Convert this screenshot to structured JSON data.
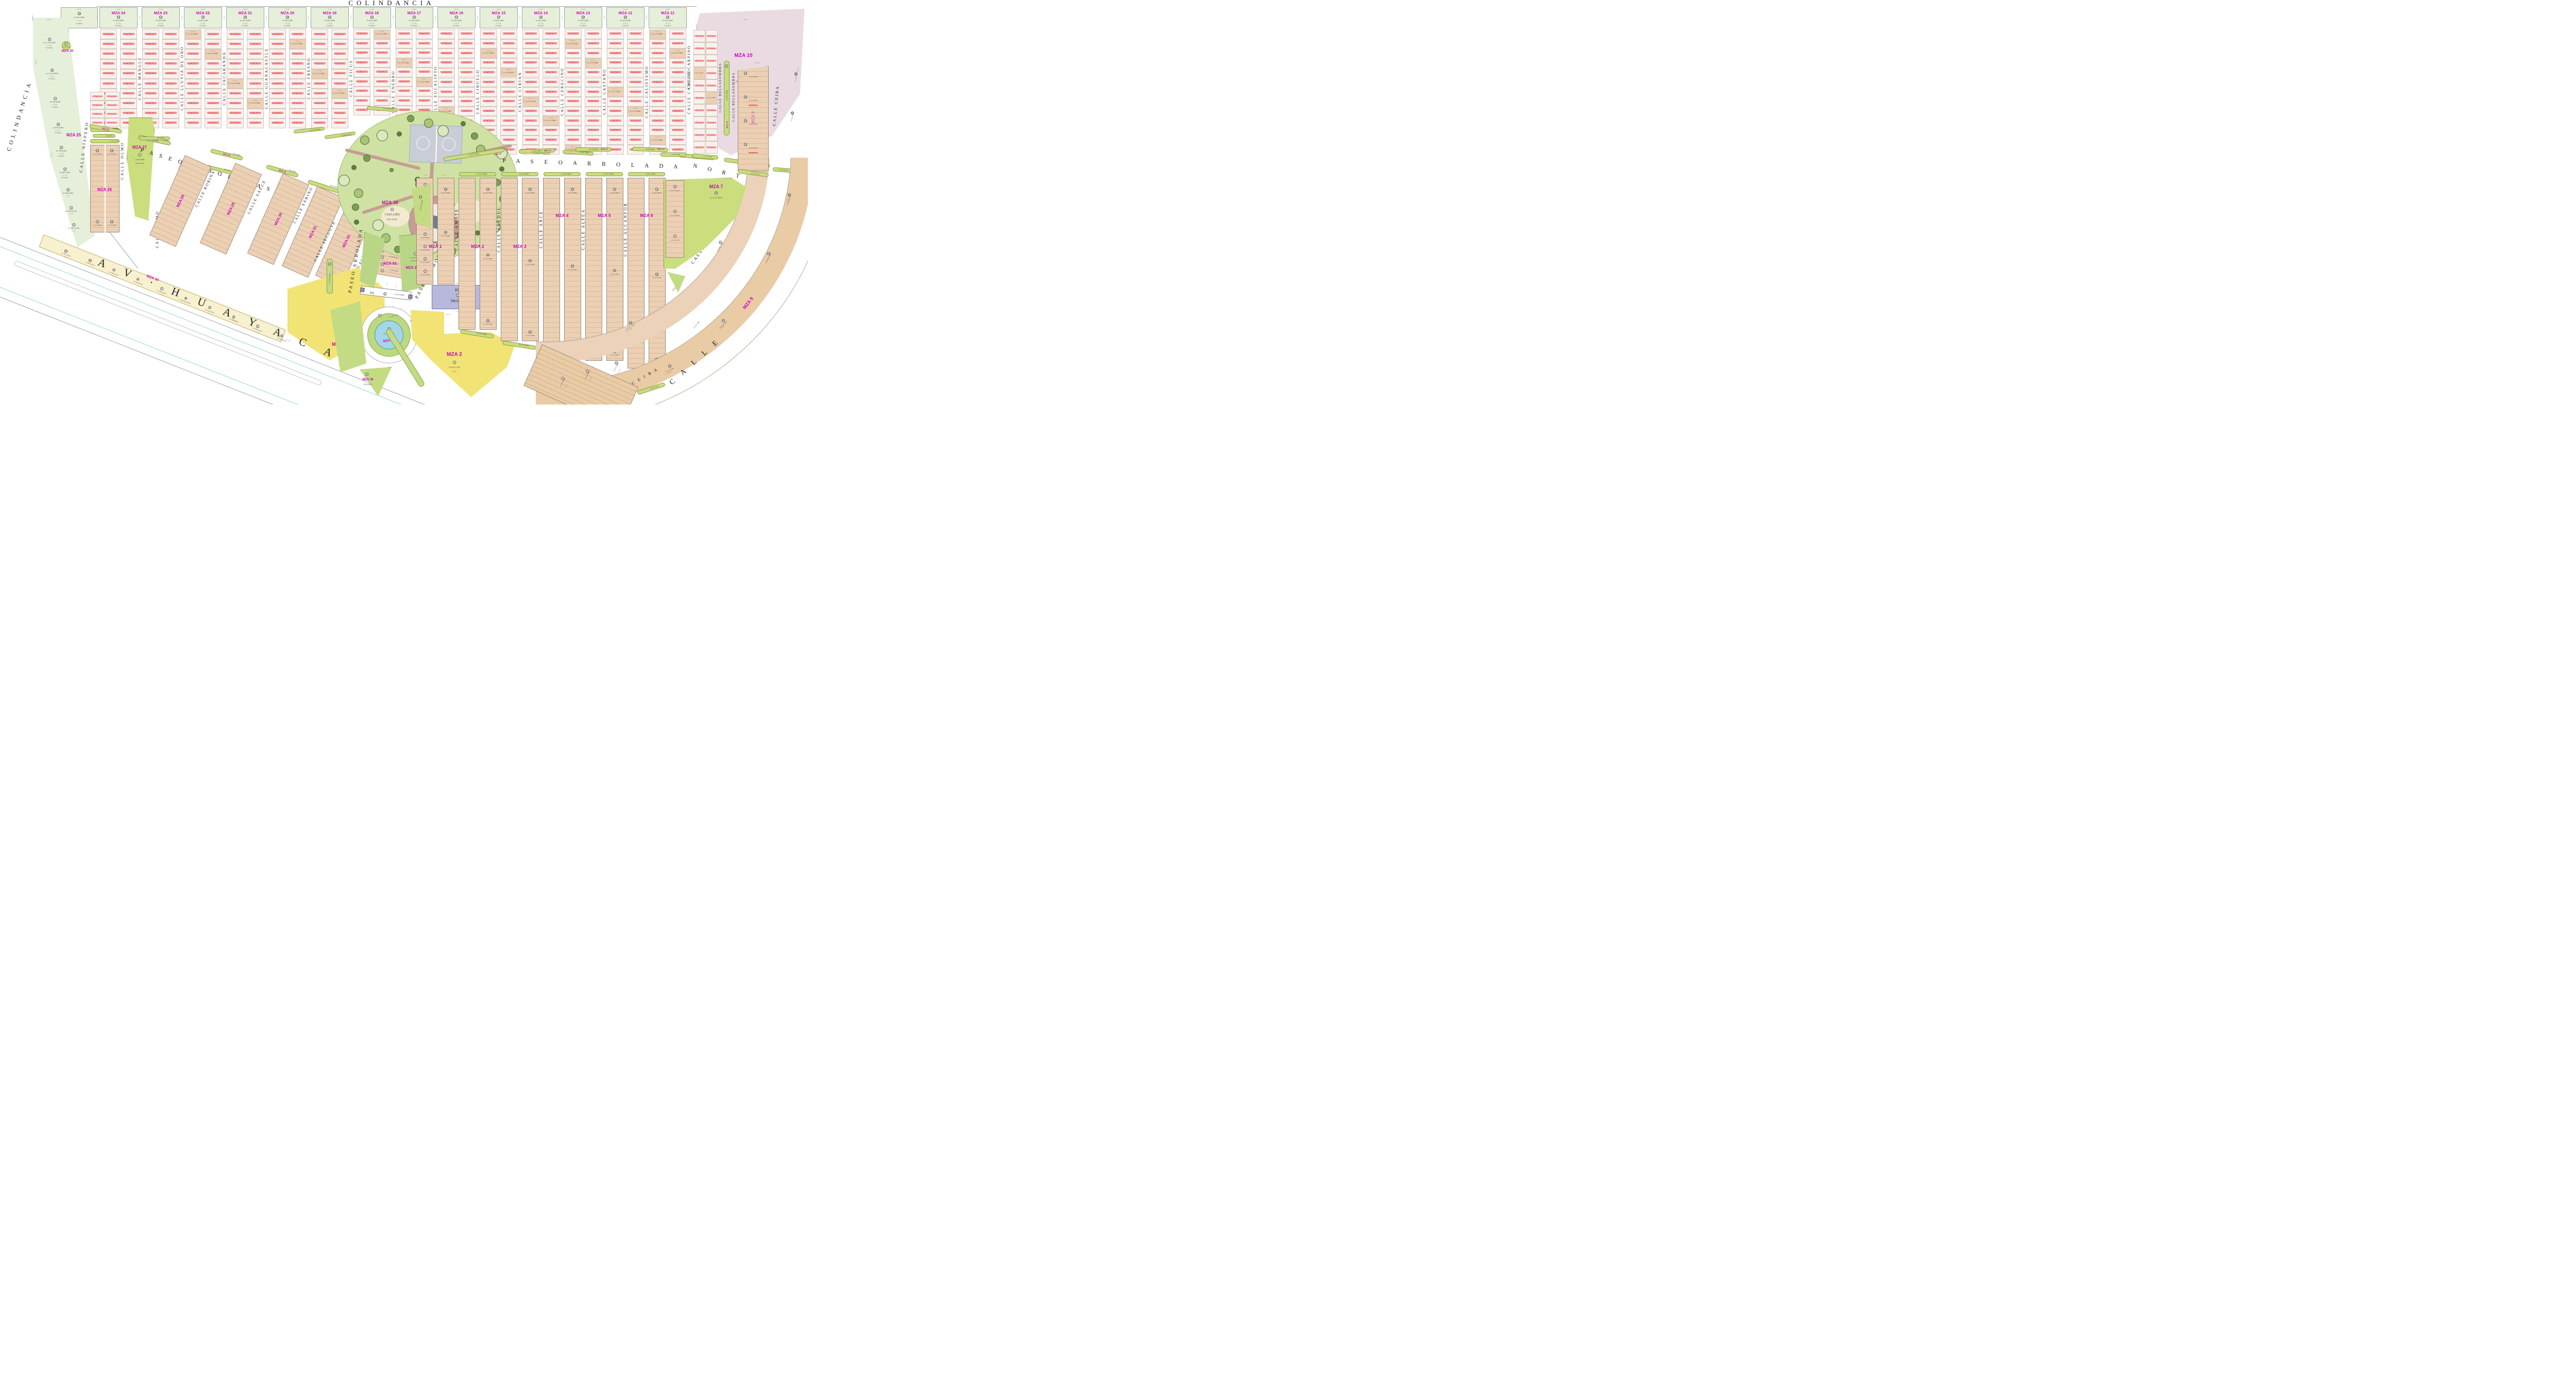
{
  "labels": {
    "colindancia": "COLINDANCIA",
    "vendido": "VENDIDO",
    "av": "A V · H U A Y A C A N",
    "paseo_sur": "P A S E O   A R B O L A D A   S U R",
    "paseo_norte_a": "P A S E O    A R B O L A D A",
    "paseo_norte_b": "N O R T E",
    "paseo_vert": "PASEO ARBOLADA",
    "paseo_diag": "PASEO  ARBOLADA",
    "calle_curve": "C A L L E",
    "area_verde": "AREA VERDE"
  },
  "top_band": {
    "extra_header": {
      "circle": "10",
      "area": "A=920.16M2",
      "viv": "14 VIV.",
      "code": "H.3.M.4.",
      "dim_top": "42.60",
      "dim_side": "21.60"
    },
    "blocks": [
      {
        "name": "MZA 24",
        "circle": "13",
        "area": "A=920.16M2",
        "viv": "14 VIV.",
        "code": "H.3.M.4.",
        "dim_top": "42.60",
        "dim_side": "21.60"
      },
      {
        "name": "MZA 23",
        "circle": "13",
        "area": "A=920.16M2",
        "viv": "14 VIV.",
        "code": "H.3.M.4.",
        "dim_top": "42.60",
        "dim_side": "21.60"
      },
      {
        "name": "MZA 22",
        "circle": "14",
        "area": "A=920.16M2",
        "viv": "14 VIV.",
        "code": "H.3.M.4.",
        "dim_top": "42.60",
        "dim_side": "21.60"
      },
      {
        "name": "MZA 21",
        "circle": "16",
        "area": "A=920.16M2",
        "viv": "14 VIV.",
        "code": "H.3.M.4.",
        "dim_top": "42.60",
        "dim_side": "21.60"
      },
      {
        "name": "MZA 20",
        "circle": "18",
        "area": "A=920.16M2",
        "viv": "14 VIV.",
        "code": "H.3.M.4.",
        "dim_top": "42.60",
        "dim_side": "21.60"
      },
      {
        "name": "MZA 19",
        "circle": "19",
        "area": "A=920.16M2",
        "viv": "14 VIV.",
        "code": "H.3.M.4.",
        "dim_top": "42.60",
        "dim_side": "21.60"
      },
      {
        "name": "MZA 18",
        "circle": "13",
        "area": "A=920.16M2",
        "viv": "14 VIV.",
        "code": "H.3.M.4.",
        "dim_top": "42.60",
        "dim_side": "21.60"
      },
      {
        "name": "MZA 17",
        "circle": "13",
        "area": "A=920.16M2",
        "viv": "14 VIV.",
        "code": "H.3.M.4.",
        "dim_top": "42.60",
        "dim_side": "21.60"
      },
      {
        "name": "MZA 16",
        "circle": "17",
        "area": "A=920.16M2",
        "viv": "14 VIV.",
        "code": "H.3.M.4.",
        "dim_top": "42.60",
        "dim_side": "21.60"
      },
      {
        "name": "MZA 15",
        "circle": "17",
        "area": "A=920.16M2",
        "viv": "14 VIV.",
        "code": "H.3.M.4.",
        "dim_top": "42.60",
        "dim_side": "21.60"
      },
      {
        "name": "MZA 14",
        "circle": "16",
        "area": "A=920.16M2",
        "viv": "14 VIV.",
        "code": "H.3.M.4.",
        "dim_top": "42.60",
        "dim_side": "21.60"
      },
      {
        "name": "MZA 13",
        "circle": "16",
        "area": "A=920.16M2",
        "viv": "14 VIV.",
        "code": "H.3.M.4.",
        "dim_top": "42.60",
        "dim_side": "21.60"
      },
      {
        "name": "MZA 12",
        "circle": "16",
        "area": "A=920.16M2",
        "viv": "14 VIV.",
        "code": "H.3.M.4.",
        "dim_top": "42.60",
        "dim_side": "21.60"
      },
      {
        "name": "MZA 11",
        "circle": "16",
        "area": "A=920.16M2",
        "viv": "14 VIV.",
        "code": "H.3.M.4.",
        "dim_top": "42.60",
        "dim_side": "21.60"
      }
    ],
    "streets": [
      "CALLE MANGLE",
      "CALLE LLUVIA DE ORO",
      "CALLE JACARANDA",
      "CALLE GUANACASTLE",
      "CALLE FRESNO",
      "CALLE FICUS",
      "CALLE ENEBRO",
      "CALLE EUCALIPTO",
      "CALLE CIRUELO",
      "CALLE CIRIAN",
      "CALLE CERECINO",
      "CALLE CASTAÑO",
      "CALLE CALISTEMO",
      "CALLE CARPINO"
    ],
    "lot": {
      "area": "A=110.16M2",
      "w": "7.20",
      "d": "15.30"
    }
  },
  "mza10": {
    "name": "MZA 10",
    "circle": "12",
    "area": "A=5,066.07M2",
    "dims": {
      "top": "86.23",
      "right": "50.83",
      "left": "57.60",
      "bottom": "58.10",
      "corner": "21.32"
    }
  },
  "mza25": {
    "name": "MZA 25",
    "lots": [
      {
        "n": "9",
        "area": "A=1,797.67M2",
        "viv": "27 VIV.",
        "code": "H.3.M.4."
      },
      {
        "n": "8",
        "area": "A=1,074.08M2",
        "viv": "16 VIV.",
        "code": "H.3.M.4."
      },
      {
        "n": "7",
        "area": "A=973.82M2",
        "viv": "15 VIV.",
        "code": "H.3.M.4."
      },
      {
        "n": "6",
        "area": "A=871.62M2",
        "viv": "13 VIV.",
        "code": "H.3.M.4."
      },
      {
        "n": "5",
        "area": "A=769.42M2",
        "viv": "12 VIV.",
        "code": "H.3.M.4."
      },
      {
        "n": "4",
        "area": "A=667.22M2",
        "viv": "10 VIV.",
        "code": "H.3.M.4."
      },
      {
        "n": "3",
        "area": "A=565.02M2",
        "viv": "8 VIV.",
        "code": "H.3.M.4."
      },
      {
        "n": "2",
        "area": "A=529.61 M2",
        "viv": "7 VIV.",
        "code": "H.3.M.4."
      },
      {
        "n": "1",
        "area": "A=390.19 M2",
        "viv": "5 VIV.",
        "code": "H.3.M.4."
      }
    ],
    "dims": [
      "46.34",
      "44.22",
      "22.11",
      "43.20",
      "25.14"
    ]
  },
  "mza35": {
    "label": "MZA 35",
    "circle_lot": {
      "n": "7",
      "area": "A=50.26M2"
    },
    "islands": [
      {
        "n": "5",
        "label": "MZA 35",
        "area": "83.00M2"
      },
      {
        "n": "4",
        "label": "MZA 35",
        "area": "87.36M2"
      },
      {
        "n": "3",
        "label": "MZA 35",
        "area": "85.50M2"
      },
      {
        "n": "2",
        "label": "MZA 35",
        "area": "88.29M2"
      },
      {
        "n": "1",
        "label": "",
        "area": "261.99M2"
      }
    ]
  },
  "left_mid": {
    "nispero": "CALLE NISPERO",
    "olmo": "CALLE OLMO",
    "mza26": {
      "name": "MZA 26",
      "strip_top": {
        "n": "23",
        "area": "106.17M2"
      },
      "pill": {
        "n": "6",
        "area": "25.47M2"
      },
      "verde": {
        "n": "26",
        "area": "A=142.38M2"
      },
      "lots": [
        {
          "n": "13",
          "area": "A=110.16M2"
        },
        {
          "n": "14",
          "area": "A=110.16M2"
        },
        {
          "n": "4",
          "area": "A=110.16M2"
        },
        {
          "n": "23",
          "area": "A=110.16M2"
        }
      ]
    },
    "mza27": {
      "name": "MZA 27",
      "n": "1",
      "area": "1,509.56M2"
    }
  },
  "diag": {
    "blocks": [
      "MZA 28",
      "MZA 29",
      "MZA 30",
      "MZA 31",
      "MZA 32"
    ],
    "streets": [
      "CALLE ROBINA",
      "CALLE SAUCE",
      "CALLE SABINO",
      "CALLE SECUOYA",
      "CALLE TAMARINDO"
    ],
    "lot": {
      "area": "A=110.16M2",
      "w": "7.20",
      "d": "15.30"
    }
  },
  "mza33": {
    "name": "MZA 33",
    "pill": {
      "n": "5",
      "area": "A=648.12 M2"
    },
    "lots": [
      {
        "n": "4",
        "area": "A=110.45M2"
      },
      {
        "n": "3",
        "area": "A=160.51M2"
      },
      {
        "n": "2",
        "area": "A=183.16M2"
      },
      {
        "n": "1",
        "area": "A=203.19M2"
      }
    ],
    "dims": [
      "13.47",
      "26.83"
    ]
  },
  "mza34": {
    "name": "MZA 34",
    "code": "C.2.a.",
    "big": {
      "n": "1",
      "area": "3,460.80M2",
      "code": "C.2.2."
    },
    "strip": [
      {
        "n": "11",
        "area": "A=766.78 M2"
      },
      {
        "n": "10",
        "area": "A=594.36 M2"
      },
      {
        "n": "9",
        "area": "A=460.08 M2"
      },
      {
        "n": "8",
        "area": "A=460.08 M2"
      },
      {
        "n": "7",
        "area": "A=460.08 M2"
      },
      {
        "n": "6",
        "area": "A=460.08 M2"
      },
      {
        "n": "5",
        "area": "A=460.08 M2"
      },
      {
        "n": "4",
        "area": "A=460.08 M2"
      },
      {
        "n": "3",
        "area": "A=460.08 M2"
      },
      {
        "n": "2",
        "area": "A=589.68 M2"
      }
    ],
    "dims": [
      "21.30",
      "21.60",
      "27.30"
    ]
  },
  "park": {
    "name": "MZA 36",
    "n": "1",
    "area": "7,620.13M2"
  },
  "park_east": {
    "name": "MZA 36",
    "n": "2",
    "area": "A=1,890.57M2"
  },
  "roundabout": {
    "name": "MZA 36",
    "pond": {
      "n": "5",
      "area": "A=376.37M2"
    },
    "ring": {
      "n": "4",
      "area": "A=150.11M2"
    },
    "green": {
      "name": "MZA 36",
      "n": "6",
      "area": "691.89M2"
    },
    "strip": {
      "n": "23",
      "area": "842.66 M2"
    }
  },
  "eq_block": {
    "label": "EQ",
    "n": "1",
    "area": "748.32 M2",
    "dims": [
      "35.41",
      "32.04",
      "33.54",
      "22.05"
    ]
  },
  "eq_gate": {
    "label": "EQ",
    "n": "3",
    "area": "A=169.66M2"
  },
  "right": {
    "streets": [
      "CALLE AMATE",
      "CALLE ABEDUL",
      "CALLE ARCE",
      "CALLE ALTEA",
      "CALLE ALCANFOR",
      "CALLE AHUEHUETE"
    ],
    "blocks": [
      {
        "name": "MZA 1",
        "lot": "A=112.46M2",
        "w": "7.35",
        "d": "15.30",
        "left_col": [
          {
            "n": "9",
            "area": "A=175.30M2"
          },
          {
            "n": "8",
            "area": "A=122.96M2"
          },
          {
            "n": "7",
            "area": "A=144.05M2"
          },
          {
            "n": "6",
            "area": "A=160.92M2"
          },
          {
            "n": "5",
            "area": "A=169.00M2"
          },
          {
            "n": "4",
            "area": "A=164.59M2"
          },
          {
            "n": "3",
            "area": "A=157.87M2"
          },
          {
            "n": "2",
            "area": "A=151.15M2"
          }
        ],
        "samples": [
          {
            "n": "18",
            "area": "A=112.46M2"
          },
          {
            "n": "20",
            "area": "A=112.46M2"
          }
        ]
      },
      {
        "name": "MZA 2",
        "lot": "A=112.46M2",
        "samples": [
          {
            "n": "16",
            "area": "A=112.46M2"
          },
          {
            "n": "31",
            "area": "A=112.46M2"
          },
          {
            "n": "45",
            "area": "A=112.46M2"
          }
        ],
        "strip_top": {
          "n": "47",
          "area": "A=157.08M2"
        },
        "strip_bottom": {
          "n": "54",
          "area": "A=185.29M2"
        }
      },
      {
        "name": "MZA 3",
        "lot": "A=112.46M2",
        "samples": [
          {
            "n": "13",
            "area": "A=112.46M2"
          },
          {
            "n": "40",
            "area": "A=112.46M2"
          },
          {
            "n": "52",
            "area": "A=112.46M2"
          }
        ],
        "strip_top": {
          "n": "53",
          "area": "A=95.14M2"
        },
        "strip_bottom": {
          "n": "52",
          "area": "A=187.98M2"
        }
      },
      {
        "name": "MZA 4",
        "lot": "A=112.46M2",
        "samples": [
          {
            "n": "19",
            "area": "A=112.46M2"
          },
          {
            "n": "34",
            "area": "A=112.46M2"
          },
          {
            "n": "43",
            "area": "A=112.46M2"
          }
        ],
        "strip_top": {
          "n": "51",
          "area": "A=93.30M2"
        },
        "strip_bottom": {
          "n": "49",
          "area": ""
        }
      },
      {
        "name": "MZA 5",
        "lot": "A=112.46M2",
        "samples": [
          {
            "n": "17",
            "area": "A=112.46M2"
          },
          {
            "n": "32",
            "area": "A=112.46M2"
          },
          {
            "n": "41",
            "area": "A=112.46M2"
          }
        ],
        "strip_top": {
          "n": "48",
          "area": "A=107.22M2"
        }
      },
      {
        "name": "MZA 6",
        "lot": "A=110.16M2",
        "samples": [
          {
            "n": "15",
            "area": "A=110.16M2"
          },
          {
            "n": "30",
            "area": "A=110.16M2"
          },
          {
            "n": "39",
            "area": "A=110.16M2"
          }
        ],
        "strip_top": {
          "n": "44",
          "area": "A=92.14M2"
        }
      }
    ],
    "wedge22": {
      "n": "22",
      "area": "A=331.67M2"
    },
    "strip27": {
      "n": "27",
      "area": "A=195.90M2"
    },
    "lot_dims": {
      "w": "7.35",
      "d": "15.30"
    }
  },
  "mza2_big": {
    "name": "MZA 2",
    "n": "1",
    "area": "3,992.22 M2",
    "code": "C.2.2."
  },
  "mza7": {
    "name": "MZA 7",
    "n": "10",
    "area": "A=1,217.08M2",
    "island": {
      "n": "6",
      "area": "A=124.87M2"
    },
    "lots": [
      {
        "n": "9",
        "area": "A=110.16M2"
      },
      {
        "n": "5",
        "area": "A=110.16M2"
      },
      {
        "n": "1",
        "area": "A=113.20M2"
      }
    ]
  },
  "mza8": {
    "name": "MZA 8",
    "samples": [
      {
        "n": "5",
        "area": "A=121.87M2",
        "lc": "LC=7.66"
      },
      {
        "n": "24",
        "area": "A=131.21M2",
        "lc": "LC=8.27"
      },
      {
        "n": "29",
        "area": "A=131.21M2",
        "lc": "LC=8.88"
      }
    ],
    "d": "15.30"
  },
  "mza9": {
    "name": "MZA 9",
    "arc_samples": [
      {
        "n": "60",
        "area": "A=120.04M2",
        "lc": "LC=8.00"
      },
      {
        "n": "55",
        "area": "A=120.04M2",
        "lc": "LC=8.00"
      },
      {
        "n": "47",
        "area": "A=120.04M2",
        "lc": "LC=8.00"
      },
      {
        "n": "33",
        "area": "A=120.04M2",
        "lc": "LC=8.00"
      }
    ],
    "upper": [
      {
        "n": "65",
        "area": "A=111.60M2"
      },
      {
        "n": "62",
        "area": "A=111.60M2"
      }
    ],
    "col": [
      {
        "n": "13",
        "area": "A=110.16M2"
      },
      {
        "n": "70",
        "area": "A=129.87M2"
      },
      {
        "n": "20",
        "area": "A=120.62M2"
      },
      {
        "n": "74",
        "area": "A=129.87M2"
      }
    ],
    "strip24": {
      "n": "24",
      "area": "A=127.27M2"
    },
    "strip45": {
      "n": "45",
      "area": "A=143.84M2"
    },
    "wedge": {
      "area": "A=251.56M2"
    },
    "d": "15.50",
    "dim58": "58.10"
  },
  "mza37": {
    "label": "MZA 37",
    "islands": [
      {
        "n": "1",
        "area": "A=457.05M2"
      },
      {
        "n": "2",
        "area": "A=92.56M2"
      },
      {
        "n": "3",
        "area": "A=90.08M2"
      },
      {
        "n": "4",
        "area": "A=88.96M2"
      },
      {
        "n": "5",
        "area": "A=90.17M2"
      },
      {
        "n": "8",
        "area": "A=339.36M2"
      },
      {
        "n": "7",
        "area": "A=19.61M2"
      }
    ]
  },
  "south_streets": {
    "carpino": "CALLE CARPINO",
    "bellasombra": "CALLE BELLASOMBRA",
    "banyan": "CALLE  BANYAN",
    "ceiba": "CALLE CEIBA",
    "ceiba_arc": "C E I B A"
  },
  "vend_col": {
    "strip32a": {
      "n": "32",
      "area": "A=131.31M2"
    },
    "strip32b": {
      "n": "32",
      "area": "A=114.36M2"
    },
    "lot": {
      "n": "25",
      "area": "A=110.16M2"
    }
  },
  "south_lots": {
    "samples": [
      {
        "n": "1",
        "area": "A=157.81M2"
      },
      {
        "n": "2",
        "area": "A=129.53M2"
      },
      {
        "n": "5",
        "area": "A=111.60M2"
      }
    ],
    "d": "15.50"
  },
  "misc_strips": [
    {
      "n": "29",
      "area": "192.98M2"
    },
    {
      "n": "31",
      "area": "86.93M2"
    },
    {
      "n": "33",
      "area": "A=299.03M2"
    },
    {
      "n": "26",
      "area": "A=128.47M2"
    },
    {
      "n": "28",
      "area": "A=273.84M2"
    },
    {
      "n": "34",
      "area": "A=79.40M2"
    },
    {
      "n": "32",
      "area": "A=86.10M2"
    },
    {
      "n": "32",
      "area": "A=52.70M2"
    },
    {
      "n": "33",
      "area": "A=155.01M2"
    }
  ]
}
